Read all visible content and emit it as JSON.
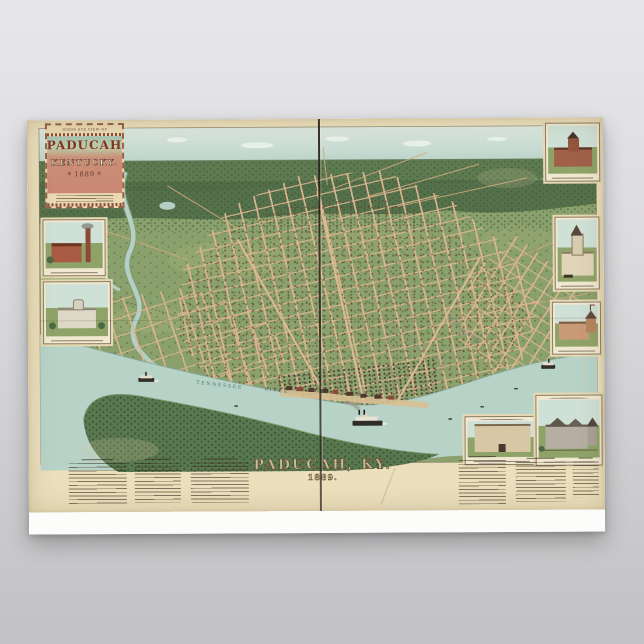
{
  "cartouche": {
    "kicker": "BIRDS EYE VIEW OF",
    "city": "PADUCAH",
    "state": "KENTUCKY.",
    "year": "1889",
    "ornament": "✻"
  },
  "map_title": {
    "city": "PADUCAH, KY.",
    "year": "1889."
  },
  "river_label": {
    "word1": "TENNESSEE",
    "word2": "RIVER"
  },
  "colors": {
    "bg-top": "#e7e6e8",
    "bg-bottom": "#c2c1c3",
    "poster-white": "#fcfcfb",
    "paper": "#ebdfbc",
    "sky": "#c9dcd2",
    "hills": "#5e7a50",
    "ground": "#8aa06d",
    "street": "#deb691",
    "river": "#b7d3c8",
    "bank": "#5a7850",
    "fold": "#2b2620",
    "ink": "#4a3a2a",
    "salmon": "#c98775"
  }
}
